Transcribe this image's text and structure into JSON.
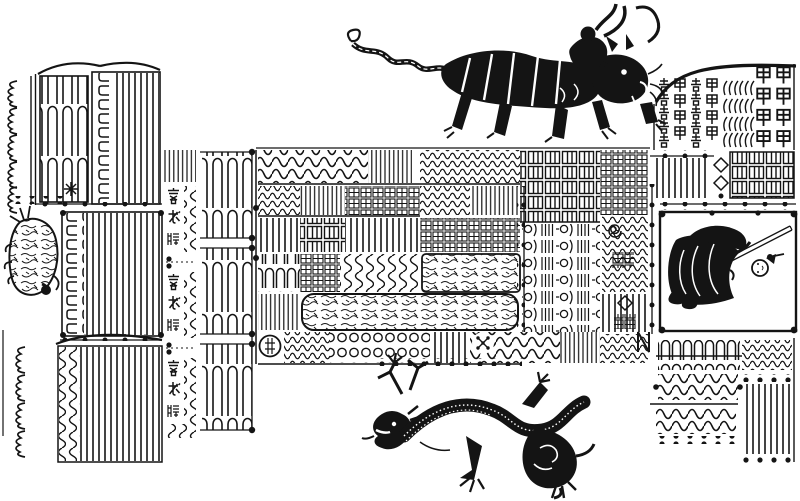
{
  "artwork": {
    "kind": "woodblock-print talisman page",
    "description": "Daoist fulu talisman diagram: maze-like seal panels, a deity riding a tiger, a coiling dragon, and a sword-bearing deity in a framed cartouche",
    "ink_color": "#141414",
    "paper_color": "#ffffff"
  },
  "figures": {
    "tiger_rider": {
      "label": "deity riding a striped tiger, tail trailing left"
    },
    "dragon": {
      "label": "scaly dragon coiling leftward with antlers and claws"
    },
    "sword_deity": {
      "label": "robed deity holding a sword, drawn rotated sideways inside a dotted frame"
    },
    "tortoise": {
      "label": "small textured beast (tortoise-like) at left margin"
    }
  },
  "inscriptions": {
    "left_invocation_column": {
      "note": "three stacked three-character seal invocations (approximate reading)",
      "blocks": [
        "帝我護",
        "帝我養",
        "帝我堂"
      ]
    },
    "top_right_seal_columns": {
      "note": "columns of repeated archaic seal characters (approximate reading)",
      "glyphs": [
        "去",
        "甲",
        "州"
      ]
    }
  },
  "panels": {
    "left_upper": {
      "label": "upper-left serpentine maze panels with wave-glyph margin column"
    },
    "left_middle": {
      "label": "middle-left comb maze panel with bracket-hook column"
    },
    "left_lower": {
      "label": "lower-left maze panel with squiggle column"
    },
    "invocation_column": {
      "label": "invocation character column with loop separators"
    },
    "serpentine_column": {
      "label": "three stacked serpentine seal blocks"
    },
    "center_band": {
      "label": "central talisman band of waves, combs, loops, grids and scribble cartouches"
    },
    "right_top": {
      "label": "top-right block of repeated seal-character columns under a sweeping stroke"
    },
    "right_mid": {
      "label": "dotted strip with diamonds and grid boxes"
    },
    "deity_frame": {
      "label": "dot-cornered frame containing the sword deity"
    },
    "right_bottom": {
      "label": "lower-right squiggle rows and dotted comb block"
    }
  }
}
